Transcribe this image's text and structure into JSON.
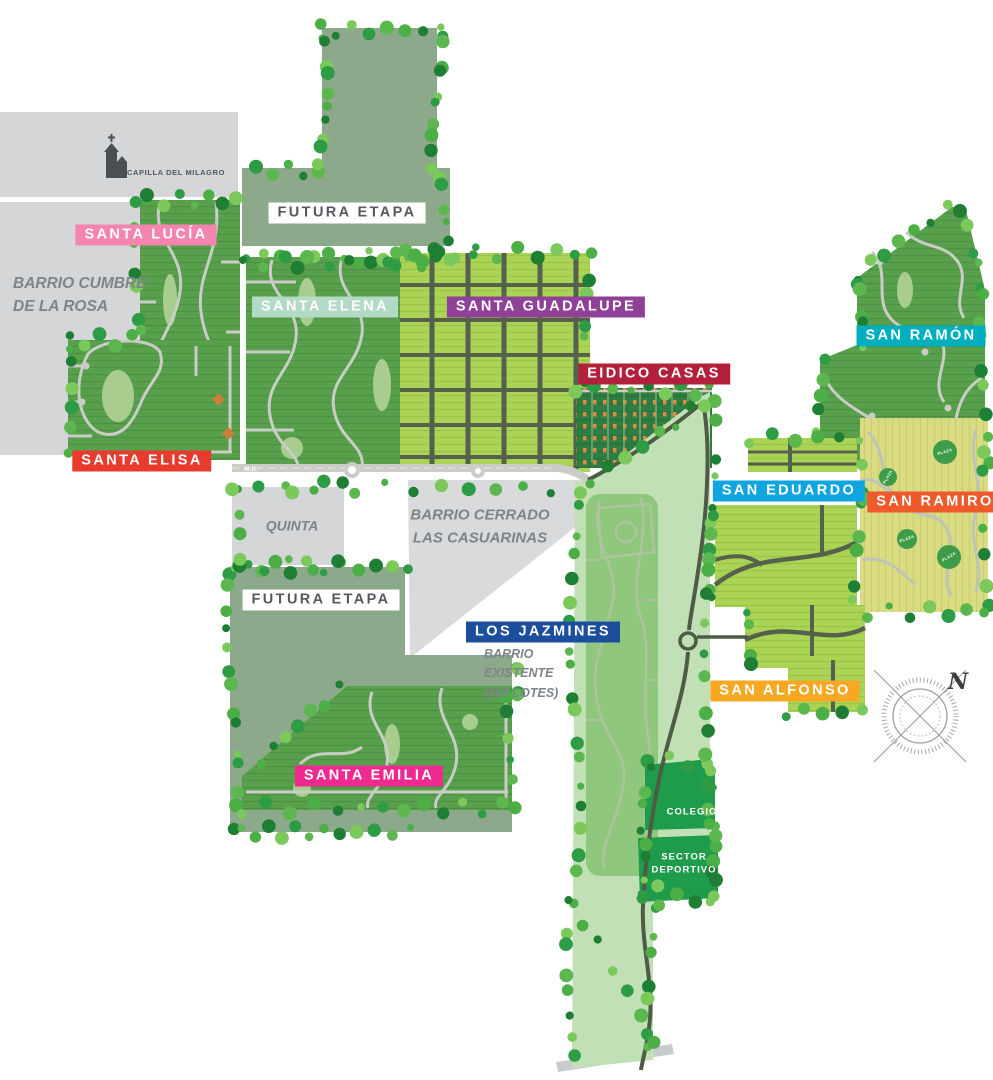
{
  "map": {
    "landmark_label": "CAPILLA DEL MILAGRO",
    "compass_label": "N",
    "road_marker": "M.D.",
    "plaza_label": "PLAZA",
    "neighborhoods": [
      {
        "id": "santa-lucia",
        "label": "SANTA LUCÍA",
        "color": "#F585AE"
      },
      {
        "id": "santa-elisa",
        "label": "SANTA ELISA",
        "color": "#E93A2E"
      },
      {
        "id": "santa-elena",
        "label": "SANTA ELENA",
        "color": "#B2DAC6"
      },
      {
        "id": "santa-guadalupe",
        "label": "SANTA GUADALUPE",
        "color": "#8F4097"
      },
      {
        "id": "eidico-casas",
        "label": "EIDICO CASAS",
        "color": "#B2203C"
      },
      {
        "id": "san-ramon",
        "label": "SAN RAMÓN",
        "color": "#00AFBE"
      },
      {
        "id": "san-eduardo",
        "label": "SAN EDUARDO",
        "color": "#0FA5E0"
      },
      {
        "id": "san-ramiro",
        "label": "SAN RAMIRO",
        "color": "#EE5A2C"
      },
      {
        "id": "san-alfonso",
        "label": "SAN ALFONSO",
        "color": "#F7A823"
      },
      {
        "id": "los-jazmines",
        "label": "LOS JAZMINES",
        "color": "#1C4E9E"
      },
      {
        "id": "santa-emilia",
        "label": "SANTA EMILIA",
        "color": "#EE2A90"
      }
    ],
    "areas": {
      "futura_etapa_1": "FUTURA ETAPA",
      "futura_etapa_2": "FUTURA ETAPA",
      "barrio_cumbre": "BARRIO CUMBRE\nDE LA ROSA",
      "quinta": "QUINTA",
      "las_casuarinas": "BARRIO CERRADO\nLAS CASUARINAS",
      "barrio_existente": "BARRIO\nEXISTENTE\n(504 LOTES)",
      "colegio": "COLEGIO",
      "sector_deportivo": "SECTOR\nDEPORTIVO"
    }
  }
}
